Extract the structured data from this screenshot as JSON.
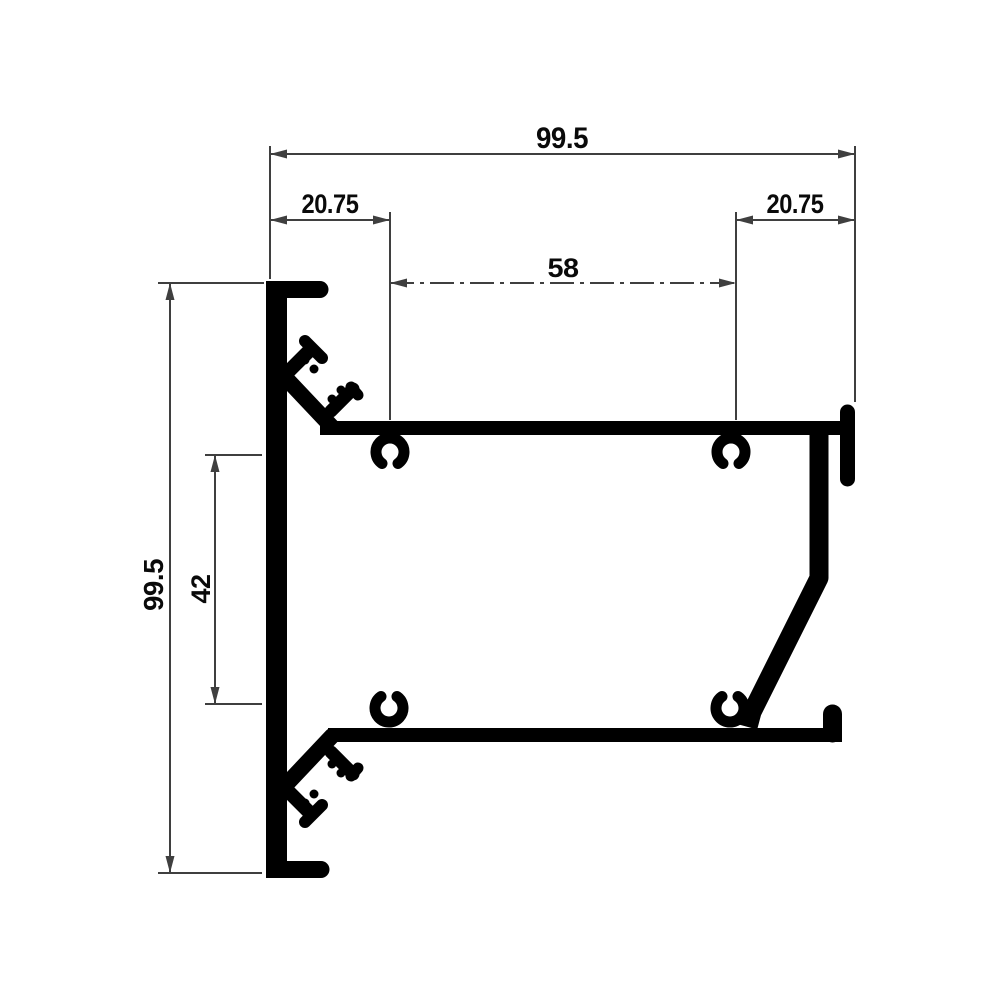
{
  "colors": {
    "background": "#ffffff",
    "profile": "#000000",
    "dimension_lines": "#3f3f3f",
    "label_text": "#0a0a0a"
  },
  "dimensions": {
    "top_total_width": "99.5",
    "top_left_offset": "20.75",
    "top_center_span": "58",
    "top_right_offset": "20.75",
    "side_total_height": "99.5",
    "side_inner_span": "42"
  }
}
